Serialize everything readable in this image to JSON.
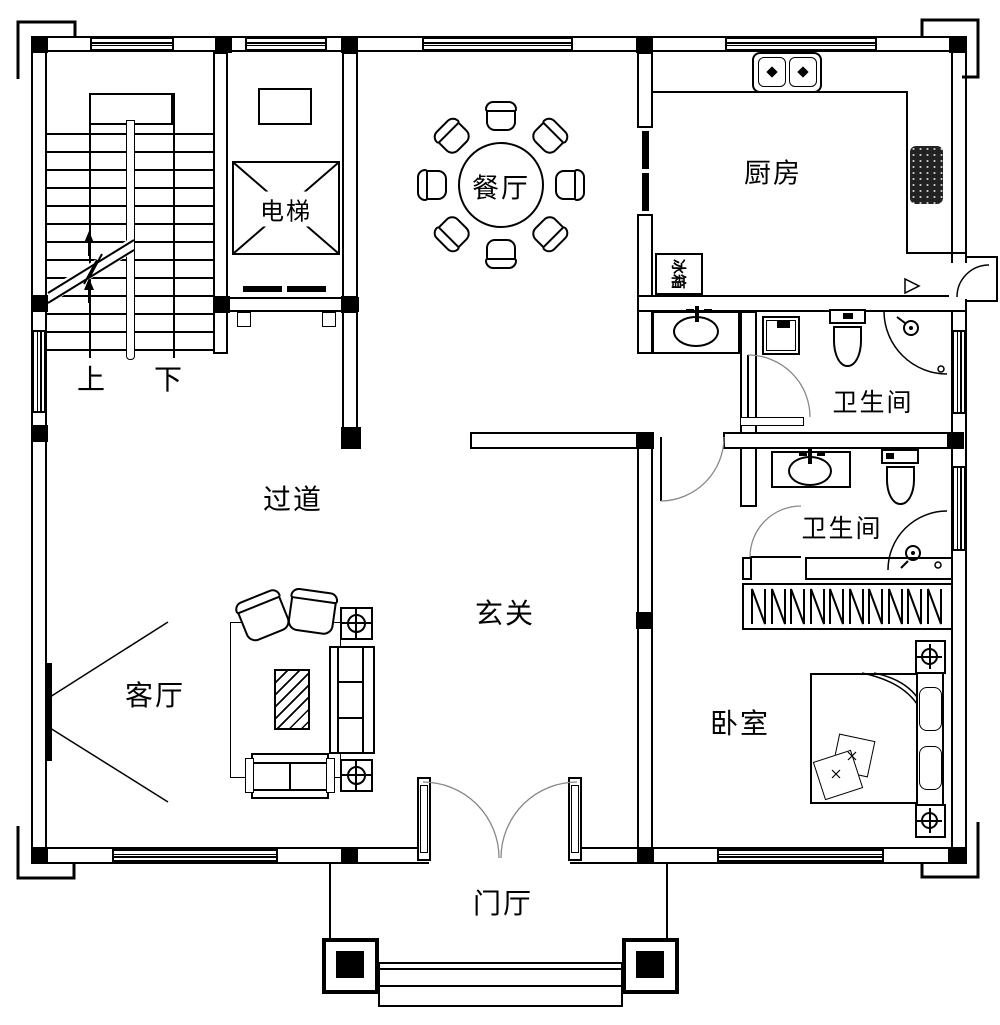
{
  "labels": {
    "dining": "餐厅",
    "kitchen": "厨房",
    "elevator": "电梯",
    "fridge": "冰箱",
    "hallway": "过道",
    "entry_hall": "玄关",
    "living": "客厅",
    "bedroom": "卧室",
    "bathroom_upper": "卫生间",
    "bathroom_lower": "卫生间",
    "foyer": "门厅",
    "stair_up": "上",
    "stair_down": "下"
  },
  "colors": {
    "line": "#000000",
    "background": "#ffffff"
  }
}
